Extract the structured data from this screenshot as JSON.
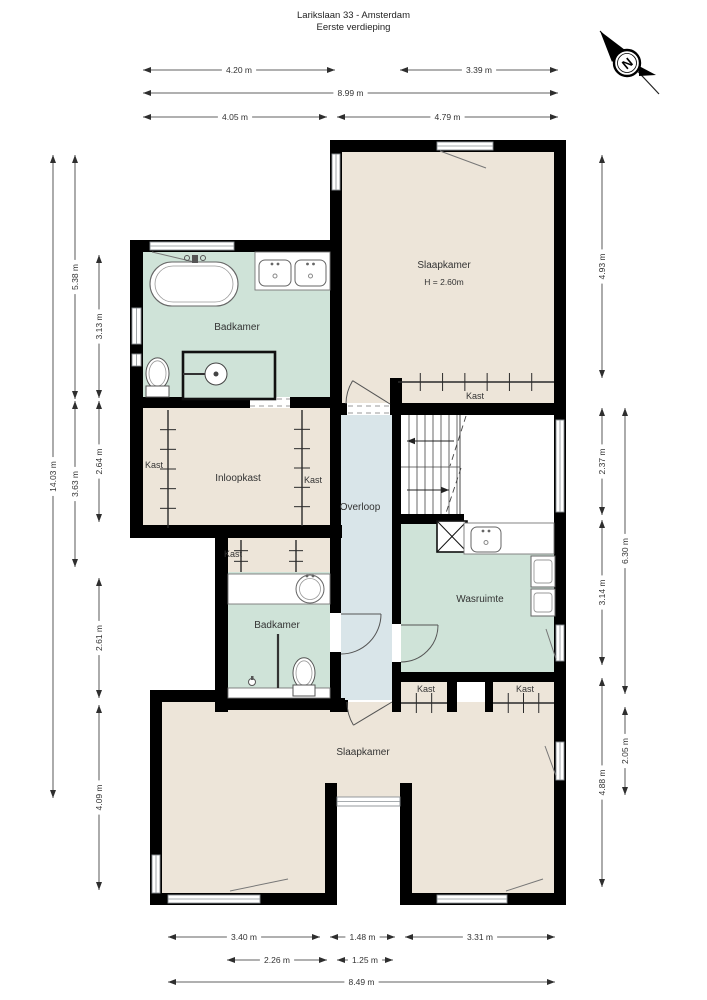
{
  "title": {
    "line1": "Larikslaan 33 - Amsterdam",
    "line2": "Eerste verdieping"
  },
  "compass": {
    "label": "N",
    "cx": 627,
    "cy": 63,
    "r": 13
  },
  "colors": {
    "wall": "#000000",
    "bedroom": "#ede5d9",
    "bath": "#cfe3d8",
    "hall": "#d9e5e9",
    "white": "#ffffff",
    "window": "#8a9094",
    "dim": "#2e2e2e",
    "fixture": "#5a5a5a",
    "label": "#333333"
  },
  "rooms": [
    {
      "name": "slaapkamer-1",
      "fill": "bedroom",
      "x": 342,
      "y": 152,
      "w": 212,
      "h": 251
    },
    {
      "name": "badkamer-1",
      "fill": "bath",
      "x": 143,
      "y": 252,
      "w": 187,
      "h": 145
    },
    {
      "name": "closet-row",
      "fill": "bedroom",
      "x": 143,
      "y": 408,
      "w": 187,
      "h": 117
    },
    {
      "name": "kast-klein-blok",
      "fill": "bedroom",
      "x": 228,
      "y": 538,
      "w": 102,
      "h": 34
    },
    {
      "name": "badkamer-2",
      "fill": "bath",
      "x": 228,
      "y": 572,
      "w": 102,
      "h": 126
    },
    {
      "name": "overloop",
      "fill": "hall",
      "x": 341,
      "y": 415,
      "w": 51,
      "h": 285
    },
    {
      "name": "stairwell",
      "fill": "white",
      "x": 401,
      "y": 415,
      "w": 153,
      "h": 99
    },
    {
      "name": "wasruimte",
      "fill": "bath",
      "x": 401,
      "y": 523,
      "w": 153,
      "h": 149
    },
    {
      "name": "kast-row",
      "fill": "bedroom",
      "x": 401,
      "y": 682,
      "w": 153,
      "h": 30
    },
    {
      "name": "passage",
      "fill": "white",
      "x": 457,
      "y": 682,
      "w": 28,
      "h": 30
    },
    {
      "name": "slaapkamer-2",
      "fill": "bedroom",
      "x": 162,
      "y": 702,
      "w": 392,
      "h": 191
    },
    {
      "name": "notch-outside",
      "fill": "white",
      "x": 337,
      "y": 806,
      "w": 63,
      "h": 99
    }
  ],
  "walls": [
    [
      330,
      140,
      236,
      12
    ],
    [
      554,
      140,
      12,
      765
    ],
    [
      330,
      140,
      12,
      263
    ],
    [
      130,
      240,
      212,
      12
    ],
    [
      130,
      240,
      13,
      298
    ],
    [
      130,
      397,
      212,
      11
    ],
    [
      130,
      525,
      212,
      13
    ],
    [
      215,
      538,
      13,
      174
    ],
    [
      330,
      403,
      17,
      12
    ],
    [
      330,
      403,
      11,
      210
    ],
    [
      330,
      652,
      11,
      60
    ],
    [
      330,
      700,
      18,
      12
    ],
    [
      390,
      378,
      12,
      37
    ],
    [
      392,
      403,
      9,
      221
    ],
    [
      392,
      662,
      9,
      50
    ],
    [
      398,
      403,
      168,
      12
    ],
    [
      392,
      514,
      72,
      10
    ],
    [
      392,
      672,
      174,
      10
    ],
    [
      447,
      672,
      10,
      40
    ],
    [
      485,
      672,
      8,
      40
    ],
    [
      150,
      690,
      12,
      215
    ],
    [
      150,
      690,
      85,
      12
    ],
    [
      215,
      698,
      130,
      12
    ],
    [
      150,
      893,
      187,
      12
    ],
    [
      400,
      893,
      166,
      12
    ],
    [
      325,
      783,
      12,
      122
    ],
    [
      400,
      783,
      12,
      122
    ]
  ],
  "windows": [
    [
      150,
      242,
      84,
      8
    ],
    [
      437,
      142,
      56,
      8
    ],
    [
      332,
      154,
      8,
      36
    ],
    [
      132,
      308,
      9,
      36
    ],
    [
      132,
      354,
      9,
      12
    ],
    [
      556,
      420,
      8,
      92
    ],
    [
      556,
      625,
      8,
      36
    ],
    [
      556,
      742,
      8,
      38
    ],
    [
      337,
      797,
      63,
      9
    ],
    [
      168,
      895,
      92,
      8
    ],
    [
      437,
      895,
      70,
      8
    ],
    [
      152,
      855,
      8,
      38
    ]
  ],
  "flaps": [
    [
      152,
      252,
      224,
      269
    ],
    [
      440,
      151,
      486,
      168
    ],
    [
      546,
      629,
      556,
      659
    ],
    [
      545,
      746,
      556,
      776
    ],
    [
      230,
      891,
      288,
      879
    ],
    [
      506,
      891,
      543,
      879
    ]
  ],
  "doors": [
    {
      "hx": 390,
      "hy": 404,
      "r": 44,
      "a0": 180,
      "a1": 212
    },
    {
      "hx": 392,
      "hy": 702,
      "r": 45,
      "a0": 180,
      "a1": 149
    },
    {
      "hx": 341,
      "hy": 614,
      "r": 40,
      "a0": 90,
      "a1": 0
    },
    {
      "hx": 401,
      "hy": 625,
      "r": 37,
      "a0": 90,
      "a1": 0
    }
  ],
  "dashed_openings": [
    {
      "x": 250,
      "y": 397,
      "w": 40,
      "h": 11
    },
    {
      "x": 348,
      "y": 404,
      "w": 42,
      "h": 11
    }
  ],
  "ticks": [
    {
      "x1": 168,
      "y1": 410,
      "x2": 168,
      "y2": 528,
      "n": 5,
      "len": 16
    },
    {
      "x1": 302,
      "y1": 410,
      "x2": 302,
      "y2": 526,
      "n": 5,
      "len": 16
    },
    {
      "x1": 241,
      "y1": 540,
      "x2": 241,
      "y2": 572,
      "n": 2,
      "len": 14
    },
    {
      "x1": 296,
      "y1": 540,
      "x2": 296,
      "y2": 572,
      "n": 2,
      "len": 14
    },
    {
      "x1": 398,
      "y1": 382,
      "x2": 554,
      "y2": 382,
      "n": 6,
      "len": 18
    },
    {
      "x1": 401,
      "y1": 703,
      "x2": 447,
      "y2": 703,
      "n": 2,
      "len": 20
    },
    {
      "x1": 493,
      "y1": 703,
      "x2": 554,
      "y2": 703,
      "n": 3,
      "len": 20
    }
  ],
  "stairs": {
    "x": 401,
    "y": 415,
    "x2": 460,
    "y2": 514,
    "midY": 467,
    "step": 8,
    "diagonals": [
      [
        466,
        416,
        450,
        466
      ],
      [
        461,
        468,
        446,
        513
      ]
    ],
    "arrows": [
      {
        "x1": 454,
        "y1": 441,
        "x2": 407,
        "y2": 441
      },
      {
        "x1": 407,
        "y1": 490,
        "x2": 449,
        "y2": 490
      }
    ]
  },
  "fixtures": [
    {
      "type": "counter",
      "x": 255,
      "y": 252,
      "w": 75,
      "h": 38
    },
    {
      "type": "sink-rect",
      "x": 259,
      "y": 260,
      "w": 32,
      "h": 26
    },
    {
      "type": "sink-rect",
      "x": 295,
      "y": 260,
      "w": 31,
      "h": 26
    },
    {
      "type": "bathtub",
      "x": 150,
      "y": 262,
      "w": 88,
      "h": 44
    },
    {
      "type": "toilet",
      "x": 146,
      "y": 357,
      "w": 23,
      "h": 41
    },
    {
      "type": "shower",
      "x": 183,
      "y": 352,
      "w": 92,
      "h": 47
    },
    {
      "type": "xbox",
      "x": 437,
      "y": 521,
      "w": 30,
      "h": 31
    },
    {
      "type": "counter",
      "x": 464,
      "y": 523,
      "w": 90,
      "h": 31
    },
    {
      "type": "sink-rect",
      "x": 471,
      "y": 527,
      "w": 30,
      "h": 25
    },
    {
      "type": "washer",
      "x": 531,
      "y": 556,
      "w": 24,
      "h": 31
    },
    {
      "type": "washer",
      "x": 531,
      "y": 589,
      "w": 24,
      "h": 27
    },
    {
      "type": "counter",
      "x": 228,
      "y": 574,
      "w": 102,
      "h": 30
    },
    {
      "type": "sink-round",
      "x": 296,
      "y": 575,
      "w": 28,
      "h": 28
    },
    {
      "type": "counter",
      "x": 228,
      "y": 688,
      "w": 102,
      "h": 10
    },
    {
      "type": "partition",
      "x": 277,
      "y": 634,
      "w": 2,
      "h": 54
    },
    {
      "type": "toilet",
      "x": 293,
      "y": 657,
      "w": 22,
      "h": 40
    },
    {
      "type": "drain",
      "x": 248,
      "y": 676,
      "w": 8,
      "h": 10
    }
  ],
  "labels": [
    {
      "t": "Slaapkamer",
      "x": 444,
      "y": 268,
      "s": 10
    },
    {
      "t": "H = 2.60m",
      "x": 444,
      "y": 285,
      "s": 8.5
    },
    {
      "t": "Badkamer",
      "x": 237,
      "y": 330,
      "s": 10
    },
    {
      "t": "Kast",
      "x": 154,
      "y": 468,
      "s": 9
    },
    {
      "t": "Inloopkast",
      "x": 238,
      "y": 481,
      "s": 10
    },
    {
      "t": "Kast",
      "x": 313,
      "y": 483,
      "s": 9
    },
    {
      "t": "Kast",
      "x": 233,
      "y": 557,
      "s": 9
    },
    {
      "t": "Overloop",
      "x": 360,
      "y": 510,
      "s": 10
    },
    {
      "t": "Kast",
      "x": 475,
      "y": 399,
      "s": 9
    },
    {
      "t": "Wasruimte",
      "x": 480,
      "y": 602,
      "s": 10
    },
    {
      "t": "Badkamer",
      "x": 277,
      "y": 628,
      "s": 10
    },
    {
      "t": "Kast",
      "x": 426,
      "y": 692,
      "s": 9
    },
    {
      "t": "Kast",
      "x": 525,
      "y": 692,
      "s": 9
    },
    {
      "t": "Slaapkamer",
      "x": 363,
      "y": 755,
      "s": 10
    }
  ],
  "dimensions": {
    "horizontal": [
      {
        "label": "4.20 m",
        "x1": 143,
        "x2": 335,
        "y": 70
      },
      {
        "label": "3.39 m",
        "x1": 400,
        "x2": 558,
        "y": 70
      },
      {
        "label": "8.99 m",
        "x1": 143,
        "x2": 558,
        "y": 93
      },
      {
        "label": "4.05 m",
        "x1": 143,
        "x2": 327,
        "y": 117
      },
      {
        "label": "4.79 m",
        "x1": 337,
        "x2": 558,
        "y": 117
      },
      {
        "label": "3.40 m",
        "x1": 168,
        "x2": 320,
        "y": 937
      },
      {
        "label": "1.48 m",
        "x1": 330,
        "x2": 395,
        "y": 937
      },
      {
        "label": "3.31 m",
        "x1": 405,
        "x2": 555,
        "y": 937
      },
      {
        "label": "2.26 m",
        "x1": 227,
        "x2": 327,
        "y": 960
      },
      {
        "label": "1.25 m",
        "x1": 337,
        "x2": 393,
        "y": 960
      },
      {
        "label": "8.49 m",
        "x1": 168,
        "x2": 555,
        "y": 982
      }
    ],
    "vertical": [
      {
        "label": "14.03 m",
        "x": 53,
        "y1": 155,
        "y2": 798
      },
      {
        "label": "5.38 m",
        "x": 75,
        "y1": 155,
        "y2": 399
      },
      {
        "label": "3.63 m",
        "x": 75,
        "y1": 401,
        "y2": 567
      },
      {
        "label": "3.13 m",
        "x": 99,
        "y1": 255,
        "y2": 398
      },
      {
        "label": "2.64 m",
        "x": 99,
        "y1": 401,
        "y2": 522
      },
      {
        "label": "2.61 m",
        "x": 99,
        "y1": 578,
        "y2": 698
      },
      {
        "label": "4.09 m",
        "x": 99,
        "y1": 705,
        "y2": 890
      },
      {
        "label": "4.93 m",
        "x": 602,
        "y1": 155,
        "y2": 378
      },
      {
        "label": "2.37 m",
        "x": 602,
        "y1": 408,
        "y2": 515
      },
      {
        "label": "3.14 m",
        "x": 602,
        "y1": 520,
        "y2": 665
      },
      {
        "label": "4.88 m",
        "x": 602,
        "y1": 678,
        "y2": 887
      },
      {
        "label": "6.30 m",
        "x": 625,
        "y1": 408,
        "y2": 694
      },
      {
        "label": "2.05 m",
        "x": 625,
        "y1": 707,
        "y2": 795
      }
    ]
  }
}
